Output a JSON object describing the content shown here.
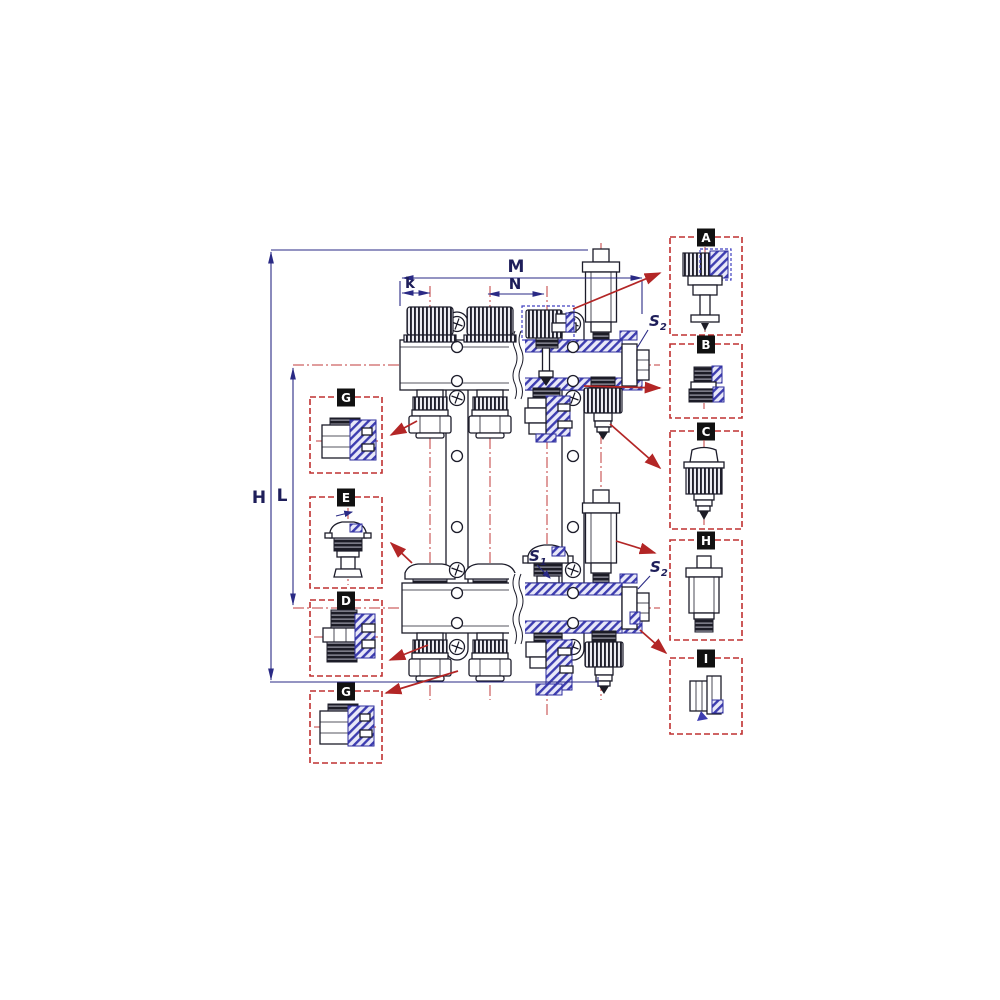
{
  "diagram_labels": {
    "m": "M",
    "n": "N",
    "k": "k",
    "h": "H",
    "l": "L",
    "s_base": "S",
    "s1_sub": "1",
    "s2_sub": "2"
  },
  "callouts": {
    "left": [
      {
        "letter": "G",
        "icon": "compression-adapter-icon"
      },
      {
        "letter": "E",
        "icon": "flow-meter-cap-icon"
      },
      {
        "letter": "D",
        "icon": "male-coupling-icon"
      },
      {
        "letter": "G",
        "icon": "compression-adapter-icon"
      }
    ],
    "right": [
      {
        "letter": "A",
        "icon": "thermostatic-valve-insert-icon"
      },
      {
        "letter": "B",
        "icon": "euroconus-fitting-icon"
      },
      {
        "letter": "C",
        "icon": "drain-connector-icon"
      },
      {
        "letter": "H",
        "icon": "air-vent-icon"
      },
      {
        "letter": "I",
        "icon": "end-plug-icon"
      }
    ]
  },
  "colors": {
    "background": "#ffffff",
    "line_dark": "#1c1c2a",
    "section_blue": "#3d3db0",
    "centerline_red": "#c23b3b",
    "callout_red": "#bf3030",
    "arrow_red": "#b32626",
    "dimension_navy": "#2a2a85"
  }
}
